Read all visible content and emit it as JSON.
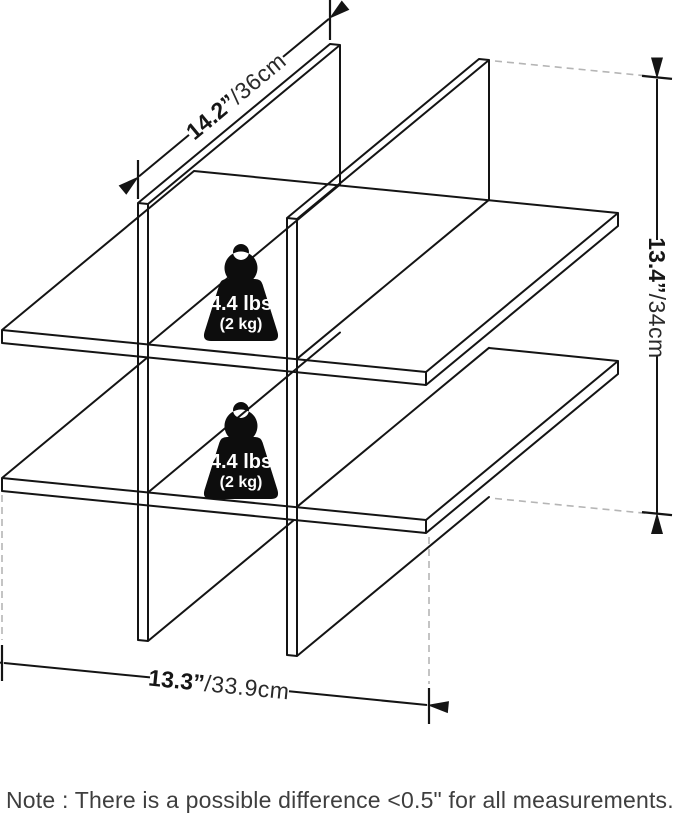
{
  "figure": {
    "description": "isometric line drawing of 4-cubby cross shelf unit",
    "dimensions": {
      "depth": {
        "value": "14.2”",
        "unit": "/36cm"
      },
      "height": {
        "value": "13.4”",
        "unit": "/34cm"
      },
      "width": {
        "value": "13.3”",
        "unit": "/33.9cm"
      }
    },
    "weight_labels": [
      {
        "lbs": "4.4 lbs",
        "kg": "(2 kg)"
      },
      {
        "lbs": "4.4 lbs",
        "kg": "(2 kg)"
      }
    ]
  },
  "note": "Note : There is a possible difference <0.5\" for all measurements.",
  "colors": {
    "line": "#141414",
    "dashed": "#b5b5b5",
    "badge": "#0d0d0d",
    "note_text": "#3e3e3e"
  }
}
